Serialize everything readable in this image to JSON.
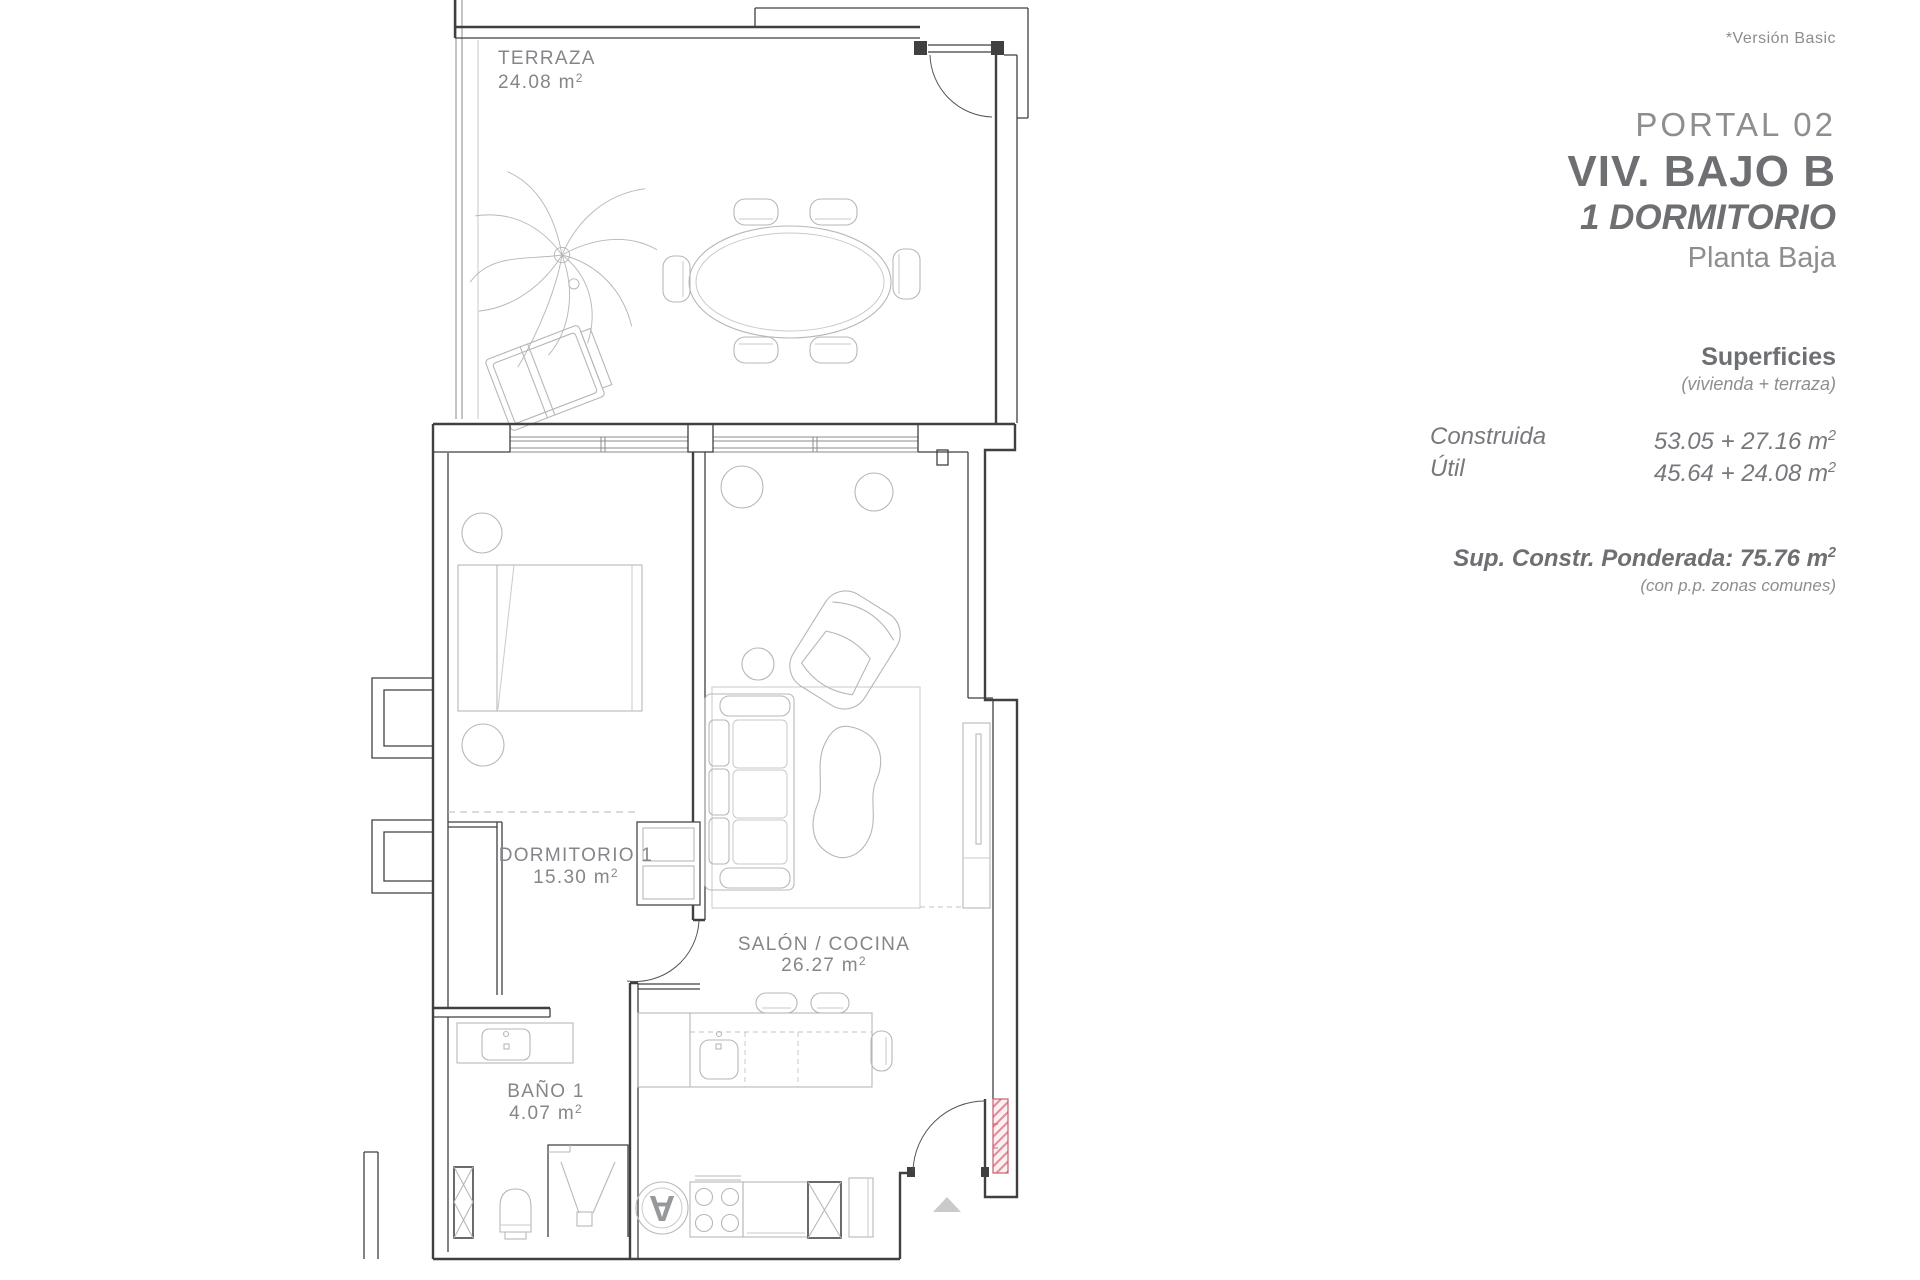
{
  "note": {
    "version": "*Versión Basic"
  },
  "header": {
    "portal": "PORTAL 02",
    "unit": "VIV. BAJO B",
    "type": "1 DORMITORIO",
    "floor": "Planta Baja"
  },
  "surfaces": {
    "title": "Superficies",
    "subtitle": "(vivienda + terraza)",
    "rows": [
      {
        "label": "Construida",
        "value": "53.05 + 27.16 m",
        "sup": "2"
      },
      {
        "label": "Útil",
        "value": "45.64 + 24.08 m",
        "sup": "2"
      }
    ],
    "weighted_label": "Sup. Constr. Ponderada: 75.76 m",
    "weighted_sup": "2",
    "weighted_note": "(con p.p. zonas comunes)"
  },
  "rooms": [
    {
      "name": "TERRAZA",
      "area": "24.08 m",
      "sup": "2"
    },
    {
      "name": "DORMITORIO 1",
      "area": "15.30 m",
      "sup": "2"
    },
    {
      "name": "SALÓN / COCINA",
      "area": "26.27 m",
      "sup": "2"
    },
    {
      "name": "BAÑO 1",
      "area": "4.07 m",
      "sup": "2"
    }
  ],
  "appliances": {
    "washer_label": "A"
  },
  "colors": {
    "wall": "#3f4042",
    "furniture": "#b6b7ba",
    "label": "#85868a",
    "accent_red": "#c4606e",
    "entrance_marker": "#c9cacc"
  }
}
